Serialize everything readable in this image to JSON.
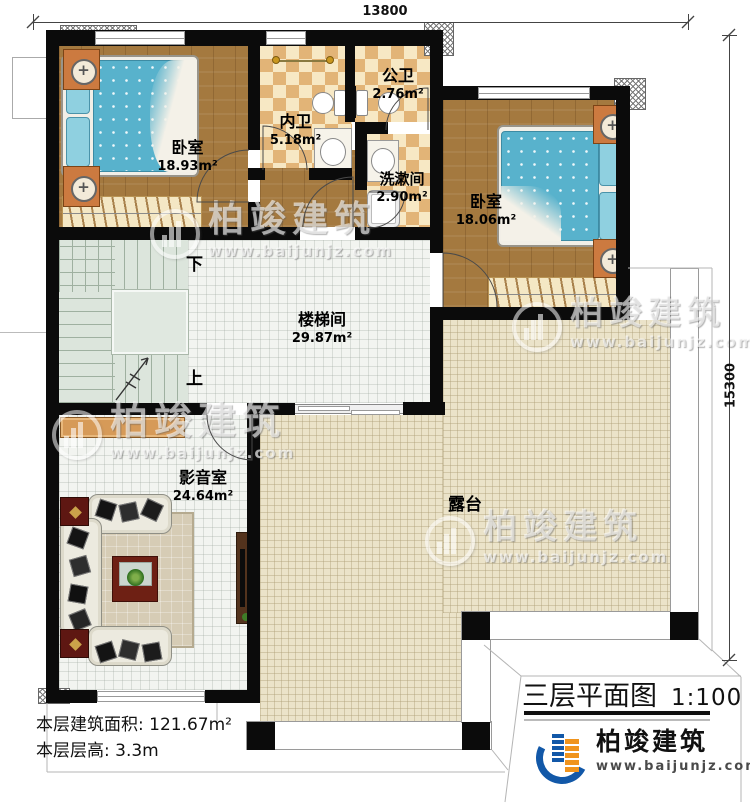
{
  "canvas": {
    "width": 750,
    "height": 803
  },
  "dimensions": {
    "top": "13800",
    "right": "15300"
  },
  "rooms": {
    "bedroom1": {
      "name": "卧室",
      "area": "18.93m²"
    },
    "inner_bath": {
      "name": "内卫",
      "area": "5.18m²"
    },
    "public_bath": {
      "name": "公卫",
      "area": "2.76m²"
    },
    "washroom": {
      "name": "洗漱间",
      "area": "2.90m²"
    },
    "bedroom2": {
      "name": "卧室",
      "area": "18.06m²"
    },
    "stairwell": {
      "name": "楼梯间",
      "area": "29.87m²"
    },
    "media_room": {
      "name": "影音室",
      "area": "24.64m²"
    },
    "terrace": {
      "name": "露台"
    }
  },
  "stairs": {
    "down": "下",
    "up": "上"
  },
  "footer": {
    "building_area": "本层建筑面积: 121.67m²",
    "floor_height": "本层层高: 3.3m"
  },
  "title_block": {
    "name": "三层平面图",
    "scale": "1:100"
  },
  "brand": {
    "name": "柏竣建筑",
    "website": "www.baijunjz.com"
  },
  "watermark": {
    "name": "柏竣建筑",
    "website": "www.baijunjz.com"
  },
  "colors": {
    "wall": "#0b0b0b",
    "wood": "#a4793f",
    "tile_light": "#f7e8c4",
    "tile_dark": "#e2b477",
    "terrace": "#ebe3c9",
    "bed": "#58b2cc",
    "brand_blue": "#1258a8",
    "brand_orange": "#f0941d"
  }
}
